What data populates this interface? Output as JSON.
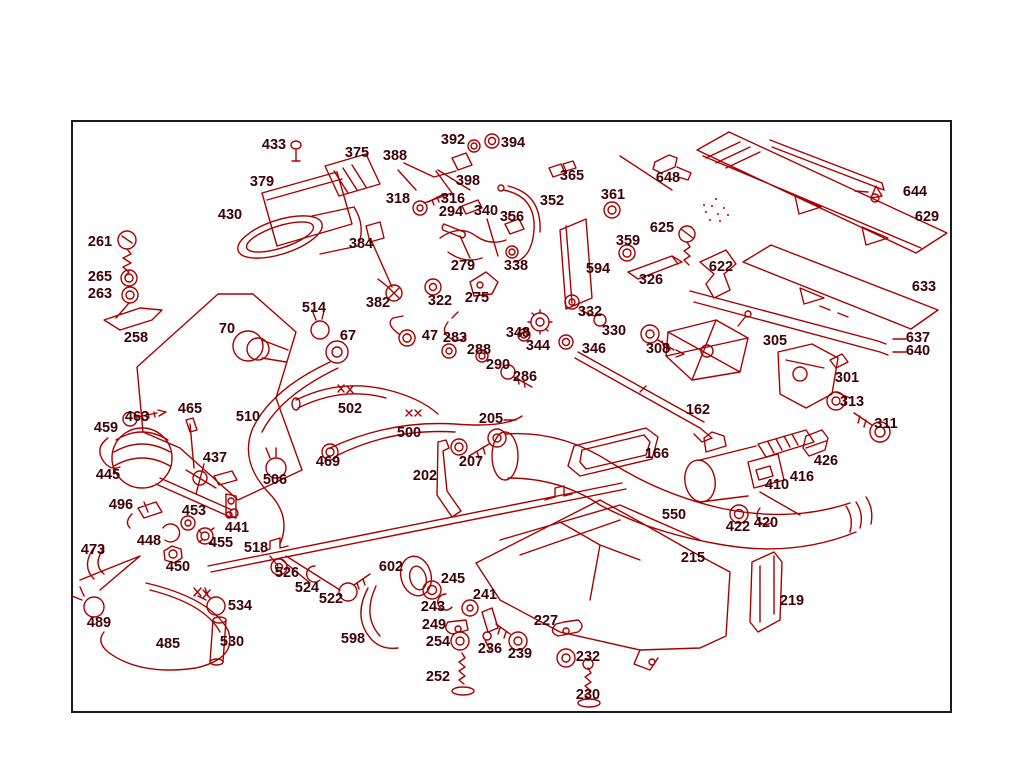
{
  "diagram": {
    "title": "exploded-parts-diagram",
    "background": "#ffffff",
    "frame_color": "#1c1c1c",
    "line_color": "#a80000",
    "label_color": "#3c0006",
    "frame": {
      "x": 71,
      "y": 120,
      "w": 881,
      "h": 593
    },
    "labels": [
      {
        "t": "433",
        "x": 274,
        "y": 146
      },
      {
        "t": "392",
        "x": 453,
        "y": 141
      },
      {
        "t": "394",
        "x": 513,
        "y": 144
      },
      {
        "t": "375",
        "x": 357,
        "y": 154
      },
      {
        "t": "388",
        "x": 395,
        "y": 157
      },
      {
        "t": "365",
        "x": 572,
        "y": 177
      },
      {
        "t": "648",
        "x": 668,
        "y": 179
      },
      {
        "t": "379",
        "x": 262,
        "y": 183
      },
      {
        "t": "398",
        "x": 468,
        "y": 182
      },
      {
        "t": "644",
        "x": 915,
        "y": 193
      },
      {
        "t": "361",
        "x": 613,
        "y": 196
      },
      {
        "t": "316",
        "x": 453,
        "y": 200
      },
      {
        "t": "318",
        "x": 398,
        "y": 200
      },
      {
        "t": "352",
        "x": 552,
        "y": 202
      },
      {
        "t": "294",
        "x": 451,
        "y": 213
      },
      {
        "t": "340",
        "x": 486,
        "y": 212
      },
      {
        "t": "356",
        "x": 512,
        "y": 218
      },
      {
        "t": "430",
        "x": 230,
        "y": 216
      },
      {
        "t": "629",
        "x": 927,
        "y": 218
      },
      {
        "t": "625",
        "x": 662,
        "y": 229
      },
      {
        "t": "261",
        "x": 100,
        "y": 243
      },
      {
        "t": "359",
        "x": 628,
        "y": 242
      },
      {
        "t": "384",
        "x": 361,
        "y": 245
      },
      {
        "t": "279",
        "x": 463,
        "y": 267
      },
      {
        "t": "338",
        "x": 516,
        "y": 267
      },
      {
        "t": "622",
        "x": 721,
        "y": 268
      },
      {
        "t": "594",
        "x": 598,
        "y": 270
      },
      {
        "t": "265",
        "x": 100,
        "y": 278
      },
      {
        "t": "326",
        "x": 651,
        "y": 281
      },
      {
        "t": "633",
        "x": 924,
        "y": 288
      },
      {
        "t": "263",
        "x": 100,
        "y": 295
      },
      {
        "t": "275",
        "x": 477,
        "y": 299
      },
      {
        "t": "322",
        "x": 440,
        "y": 302
      },
      {
        "t": "382",
        "x": 378,
        "y": 304
      },
      {
        "t": "514",
        "x": 314,
        "y": 309
      },
      {
        "t": "332",
        "x": 590,
        "y": 313
      },
      {
        "t": "70",
        "x": 227,
        "y": 330
      },
      {
        "t": "330",
        "x": 614,
        "y": 332
      },
      {
        "t": "67",
        "x": 348,
        "y": 337
      },
      {
        "t": "47",
        "x": 430,
        "y": 337
      },
      {
        "t": "283",
        "x": 455,
        "y": 339
      },
      {
        "t": "258",
        "x": 136,
        "y": 339
      },
      {
        "t": "637",
        "x": 918,
        "y": 339
      },
      {
        "t": "305",
        "x": 775,
        "y": 342
      },
      {
        "t": "348",
        "x": 518,
        "y": 334
      },
      {
        "t": "344",
        "x": 538,
        "y": 347
      },
      {
        "t": "346",
        "x": 594,
        "y": 350
      },
      {
        "t": "308",
        "x": 658,
        "y": 350
      },
      {
        "t": "288",
        "x": 479,
        "y": 351
      },
      {
        "t": "640",
        "x": 918,
        "y": 352
      },
      {
        "t": "290",
        "x": 498,
        "y": 366
      },
      {
        "t": "286",
        "x": 525,
        "y": 378
      },
      {
        "t": "301",
        "x": 847,
        "y": 379
      },
      {
        "t": "313",
        "x": 852,
        "y": 403
      },
      {
        "t": "162",
        "x": 698,
        "y": 411
      },
      {
        "t": "502",
        "x": 350,
        "y": 410
      },
      {
        "t": "465",
        "x": 190,
        "y": 410
      },
      {
        "t": "510",
        "x": 248,
        "y": 418
      },
      {
        "t": "463",
        "x": 137,
        "y": 418
      },
      {
        "t": "205",
        "x": 491,
        "y": 420
      },
      {
        "t": "311",
        "x": 886,
        "y": 425
      },
      {
        "t": "459",
        "x": 106,
        "y": 429
      },
      {
        "t": "500",
        "x": 409,
        "y": 434
      },
      {
        "t": "166",
        "x": 657,
        "y": 455
      },
      {
        "t": "437",
        "x": 215,
        "y": 459
      },
      {
        "t": "426",
        "x": 826,
        "y": 462
      },
      {
        "t": "207",
        "x": 471,
        "y": 463
      },
      {
        "t": "469",
        "x": 328,
        "y": 463
      },
      {
        "t": "445",
        "x": 108,
        "y": 476
      },
      {
        "t": "202",
        "x": 425,
        "y": 477
      },
      {
        "t": "416",
        "x": 802,
        "y": 478
      },
      {
        "t": "410",
        "x": 777,
        "y": 486
      },
      {
        "t": "506",
        "x": 275,
        "y": 481
      },
      {
        "t": "496",
        "x": 121,
        "y": 506
      },
      {
        "t": "453",
        "x": 194,
        "y": 512
      },
      {
        "t": "550",
        "x": 674,
        "y": 516
      },
      {
        "t": "420",
        "x": 766,
        "y": 524
      },
      {
        "t": "422",
        "x": 738,
        "y": 528
      },
      {
        "t": "441",
        "x": 237,
        "y": 529
      },
      {
        "t": "448",
        "x": 149,
        "y": 542
      },
      {
        "t": "455",
        "x": 221,
        "y": 544
      },
      {
        "t": "518",
        "x": 256,
        "y": 549
      },
      {
        "t": "473",
        "x": 93,
        "y": 551
      },
      {
        "t": "215",
        "x": 693,
        "y": 559
      },
      {
        "t": "450",
        "x": 178,
        "y": 568
      },
      {
        "t": "602",
        "x": 391,
        "y": 568
      },
      {
        "t": "526",
        "x": 287,
        "y": 574
      },
      {
        "t": "245",
        "x": 453,
        "y": 580
      },
      {
        "t": "524",
        "x": 307,
        "y": 589
      },
      {
        "t": "241",
        "x": 485,
        "y": 596
      },
      {
        "t": "522",
        "x": 331,
        "y": 600
      },
      {
        "t": "219",
        "x": 792,
        "y": 602
      },
      {
        "t": "534",
        "x": 240,
        "y": 607
      },
      {
        "t": "243",
        "x": 433,
        "y": 608
      },
      {
        "t": "227",
        "x": 546,
        "y": 622
      },
      {
        "t": "489",
        "x": 99,
        "y": 624
      },
      {
        "t": "249",
        "x": 434,
        "y": 626
      },
      {
        "t": "530",
        "x": 232,
        "y": 643
      },
      {
        "t": "254",
        "x": 438,
        "y": 643
      },
      {
        "t": "598",
        "x": 353,
        "y": 640
      },
      {
        "t": "485",
        "x": 168,
        "y": 645
      },
      {
        "t": "236",
        "x": 490,
        "y": 650
      },
      {
        "t": "239",
        "x": 520,
        "y": 655
      },
      {
        "t": "232",
        "x": 588,
        "y": 658
      },
      {
        "t": "252",
        "x": 438,
        "y": 678
      },
      {
        "t": "230",
        "x": 588,
        "y": 696
      }
    ],
    "leader_dashes": [
      [
        893,
        339,
        906,
        339
      ],
      [
        893,
        352,
        906,
        352
      ],
      [
        855,
        191,
        868,
        192
      ],
      [
        504,
        420,
        516,
        420
      ],
      [
        620,
        156,
        672,
        190
      ],
      [
        438,
        170,
        470,
        190
      ]
    ]
  }
}
